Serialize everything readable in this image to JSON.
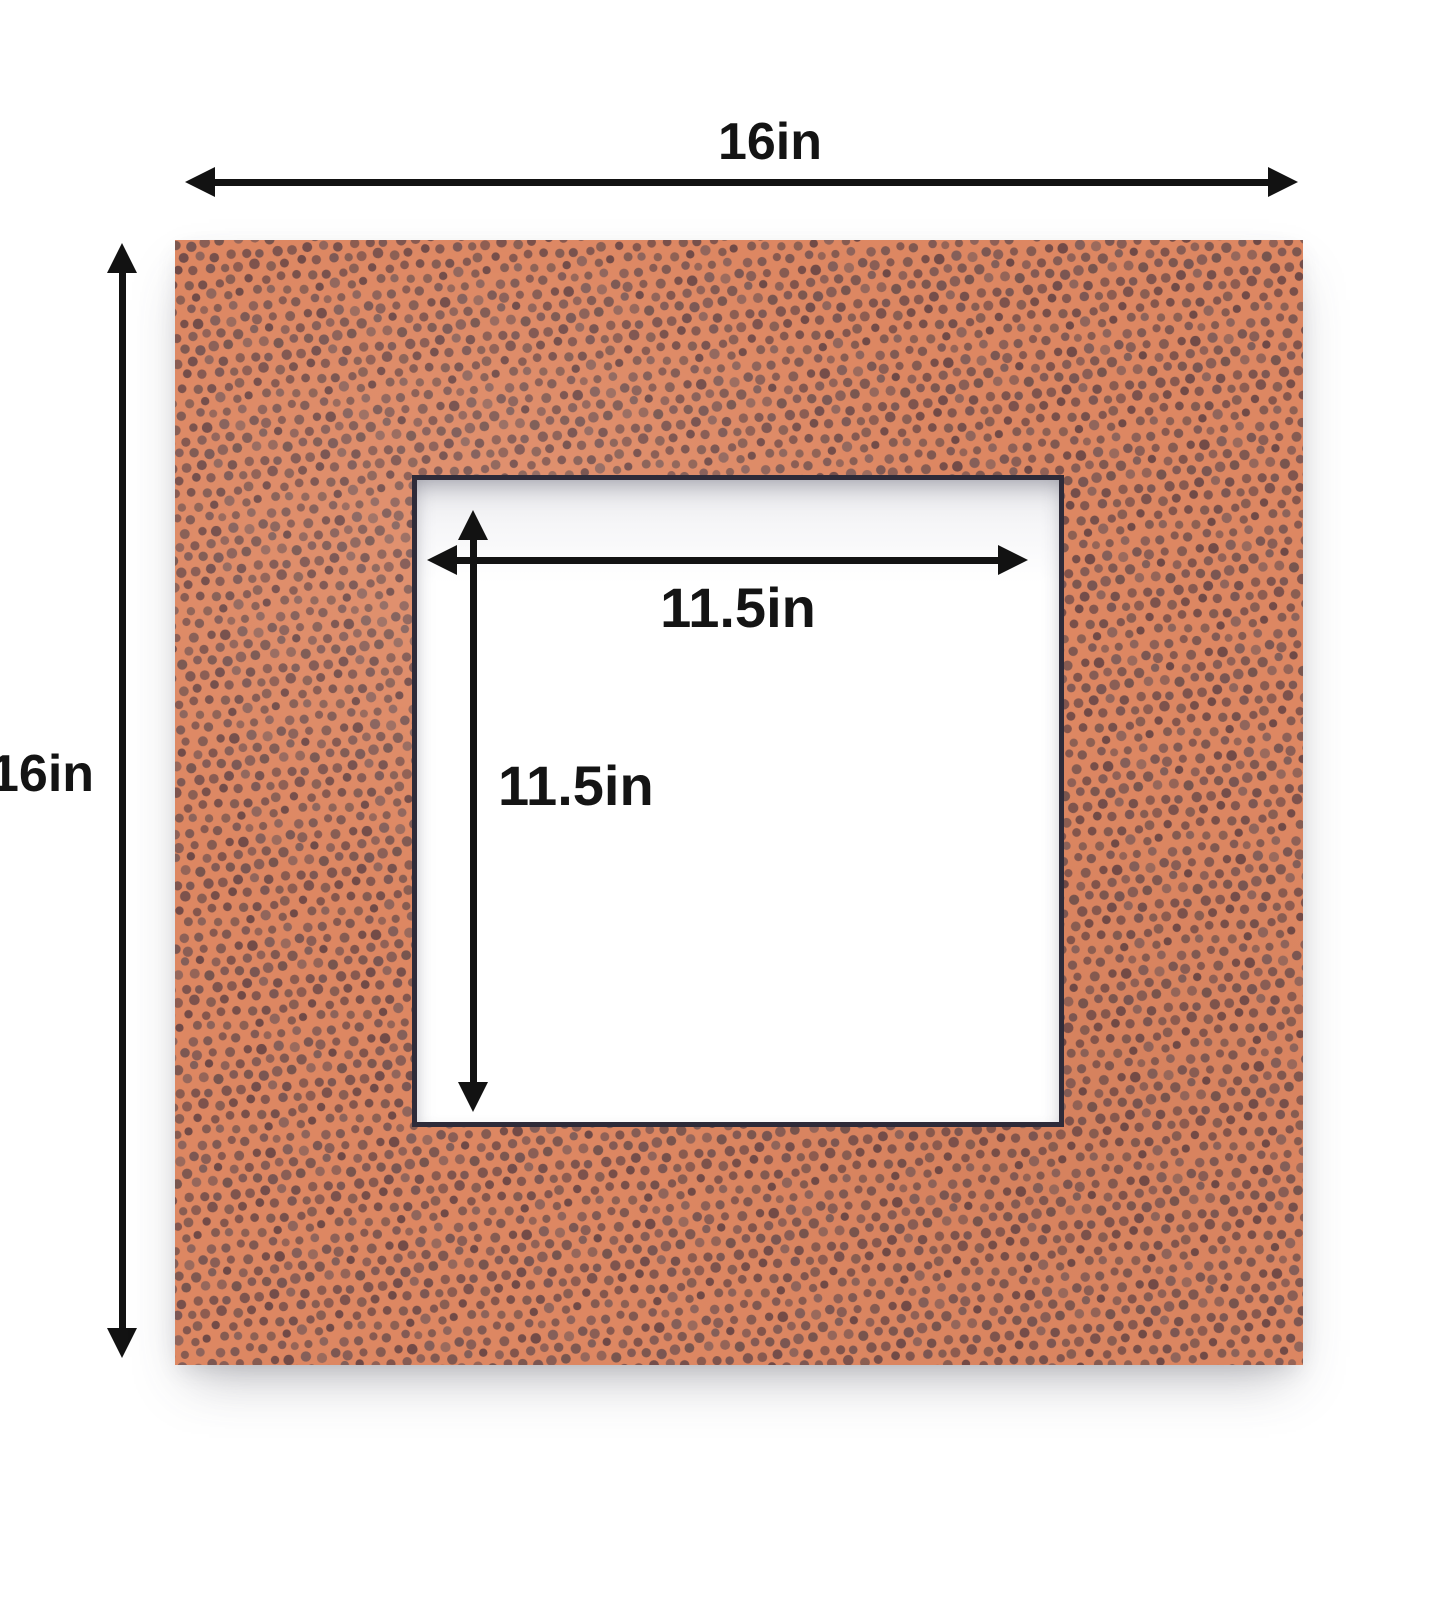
{
  "diagram": {
    "type": "mat-board-dimension-diagram",
    "outer": {
      "width_label": "16in",
      "height_label": "16in"
    },
    "opening": {
      "width_label": "11.5in",
      "height_label": "11.5in"
    },
    "colors": {
      "mat_base": "#dd8762",
      "mat_dots": "#6d4a48",
      "bevel": "#2e2b39",
      "arrow": "#121212",
      "background": "#ffffff"
    },
    "texture": "football-leather-pebble-dots"
  }
}
